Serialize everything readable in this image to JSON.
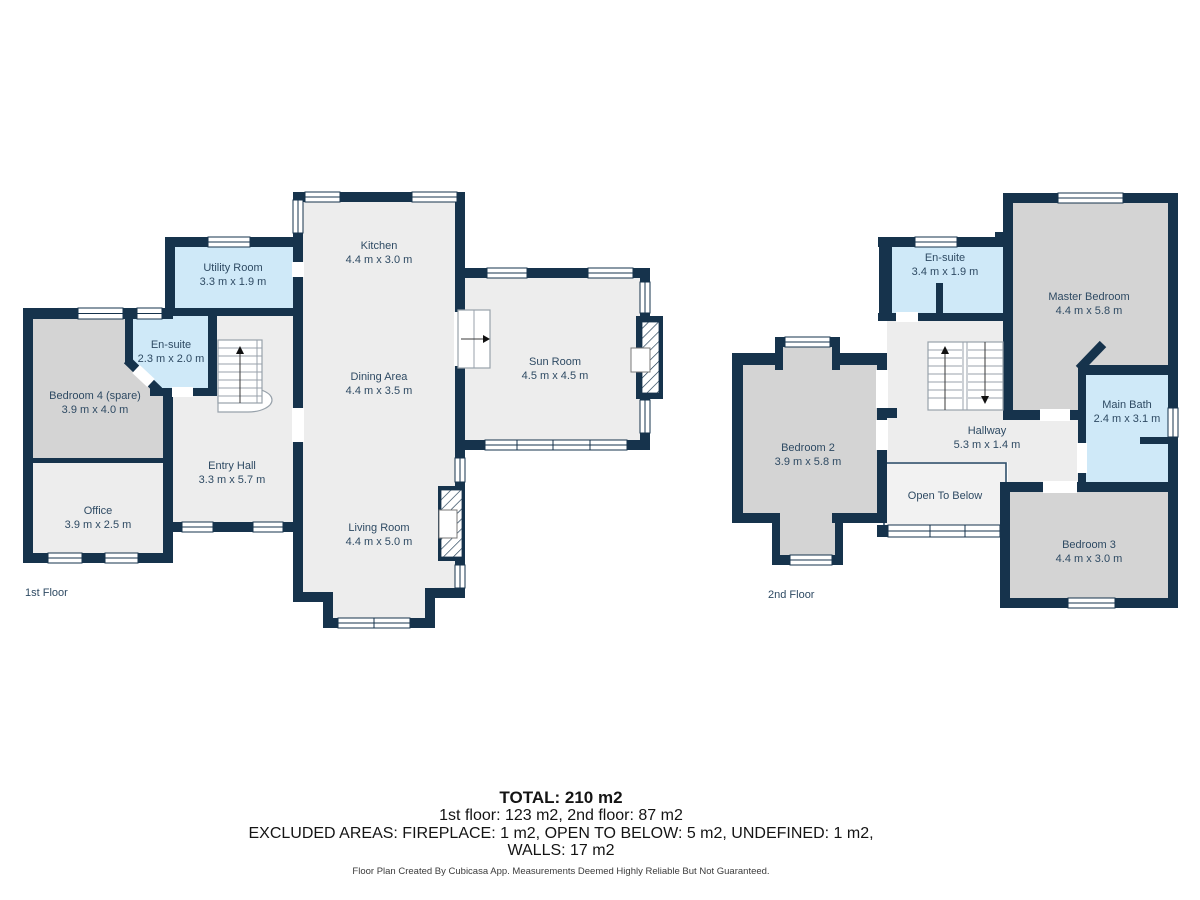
{
  "colors": {
    "wall": "#16334c",
    "floor": "#ededed",
    "bedroom_fill": "#d4d4d4",
    "wet_room_fill": "#cfe9f8",
    "open_to_below_fill": "#f2f2f2",
    "label_text": "#2e4a63",
    "summary_text": "#141414"
  },
  "floors": [
    {
      "label": "1st Floor",
      "rooms": [
        {
          "name": "Kitchen",
          "dims": "4.4 m x 3.0 m"
        },
        {
          "name": "Dining Area",
          "dims": "4.4 m x 3.5 m"
        },
        {
          "name": "Living Room",
          "dims": "4.4 m x 5.0 m"
        },
        {
          "name": "Sun Room",
          "dims": "4.5 m x 4.5 m"
        },
        {
          "name": "Utility Room",
          "dims": "3.3 m x 1.9 m"
        },
        {
          "name": "En-suite",
          "dims": "2.3 m x 2.0 m"
        },
        {
          "name": "Bedroom 4 (spare)",
          "dims": "3.9 m x 4.0 m"
        },
        {
          "name": "Office",
          "dims": "3.9 m x 2.5 m"
        },
        {
          "name": "Entry Hall",
          "dims": "3.3 m x 5.7 m"
        }
      ]
    },
    {
      "label": "2nd Floor",
      "rooms": [
        {
          "name": "En-suite",
          "dims": "3.4 m x 1.9 m"
        },
        {
          "name": "Master Bedroom",
          "dims": "4.4 m x 5.8 m"
        },
        {
          "name": "Bedroom 2",
          "dims": "3.9 m x 5.8 m"
        },
        {
          "name": "Hallway",
          "dims": "5.3 m x 1.4 m"
        },
        {
          "name": "Main Bath",
          "dims": "2.4 m x 3.1 m"
        },
        {
          "name": "Open To Below",
          "dims": ""
        },
        {
          "name": "Bedroom 3",
          "dims": "4.4 m x 3.0 m"
        }
      ]
    }
  ],
  "summary": {
    "total": "TOTAL: 210 m2",
    "floors_line": "1st floor: 123 m2, 2nd floor: 87 m2",
    "excluded_line": "EXCLUDED AREAS: FIREPLACE: 1 m2, OPEN TO BELOW: 5 m2, UNDEFINED: 1 m2,",
    "walls_line": "WALLS: 17 m2",
    "credit": "Floor Plan Created By Cubicasa App. Measurements Deemed Highly Reliable But Not Guaranteed."
  }
}
